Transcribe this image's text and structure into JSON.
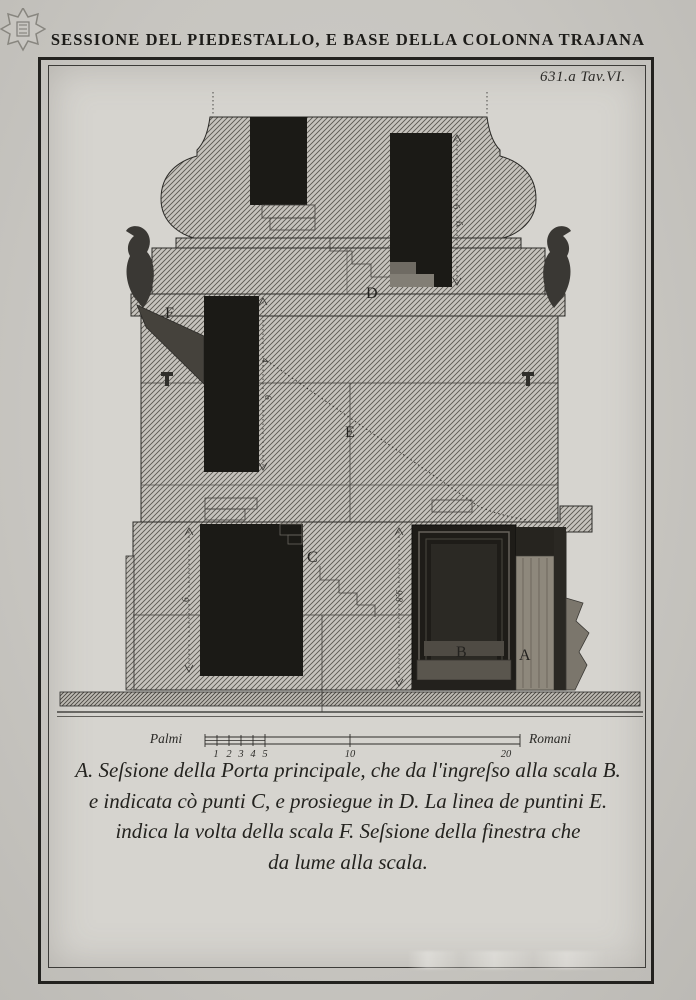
{
  "plate": {
    "title": "SESSIONE DEL PIEDESTALLO, E BASE DELLA COLONNA TRAJANA",
    "plate_number": "631.a Tav.VI.",
    "labels": {
      "A": "A",
      "B": "B",
      "C": "C",
      "D": "D",
      "E": "E",
      "F": "F"
    },
    "dimensions": {
      "d1": "6",
      "d2": "6",
      "d3": "4",
      "d4": "6",
      "d5": "9",
      "d6": "9.8"
    },
    "scale_bar": {
      "left_label": "Palmi",
      "right_label": "Romani",
      "ticks": [
        "1",
        "2",
        "3",
        "4",
        "5",
        "10",
        "20"
      ]
    },
    "caption": {
      "line1": "A. Seſsione della Porta principale, che da l'ingreſso alla scala B.",
      "line2": "e indicata cò punti C, e prosiegue in D.  La linea de puntini E.",
      "line3": "indica la volta della scala F.  Seſsione della finestra che",
      "line4": "da lume alla scala."
    },
    "colors": {
      "paper": "#d6d4cf",
      "ink": "#23221f",
      "opening": "#1b1a16"
    }
  }
}
